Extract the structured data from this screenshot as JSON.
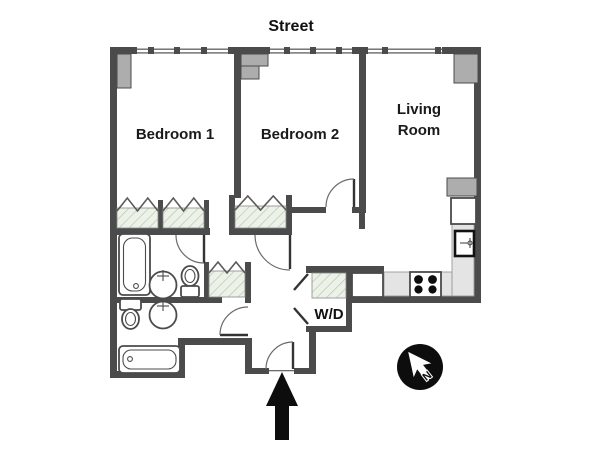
{
  "labels": {
    "street": "Street",
    "bedroom1": "Bedroom 1",
    "bedroom2": "Bedroom 2",
    "living_room_line1": "Living",
    "living_room_line2": "Room",
    "washer_dryer": "W/D",
    "compass_north": "N"
  },
  "colors": {
    "wall": "#4b4b4b",
    "pilaster": "#adadad",
    "hatchbg": "#ecf2e8",
    "hatchline": "#b9c7b1",
    "counter": "#e4e4e4",
    "ink": "#0d0d0d",
    "bg": "#ffffff"
  },
  "icons": {
    "compass": "north-arrow-in-circle",
    "entry": "up-arrow-entrance-marker",
    "closets": "diagonal-hatch-with-bifold-zigzag",
    "windows": "thin-double-line-with-mullion-ticks"
  },
  "fixtures": [
    "bathtub-vertical",
    "bathtub-horizontal",
    "toilet-upper",
    "toilet-lower",
    "round-sink-upper",
    "round-sink-lower",
    "stove-4-burner",
    "kitchen-sink",
    "refrigerator",
    "kitchen-cabinet",
    "washer-dryer-closet"
  ]
}
